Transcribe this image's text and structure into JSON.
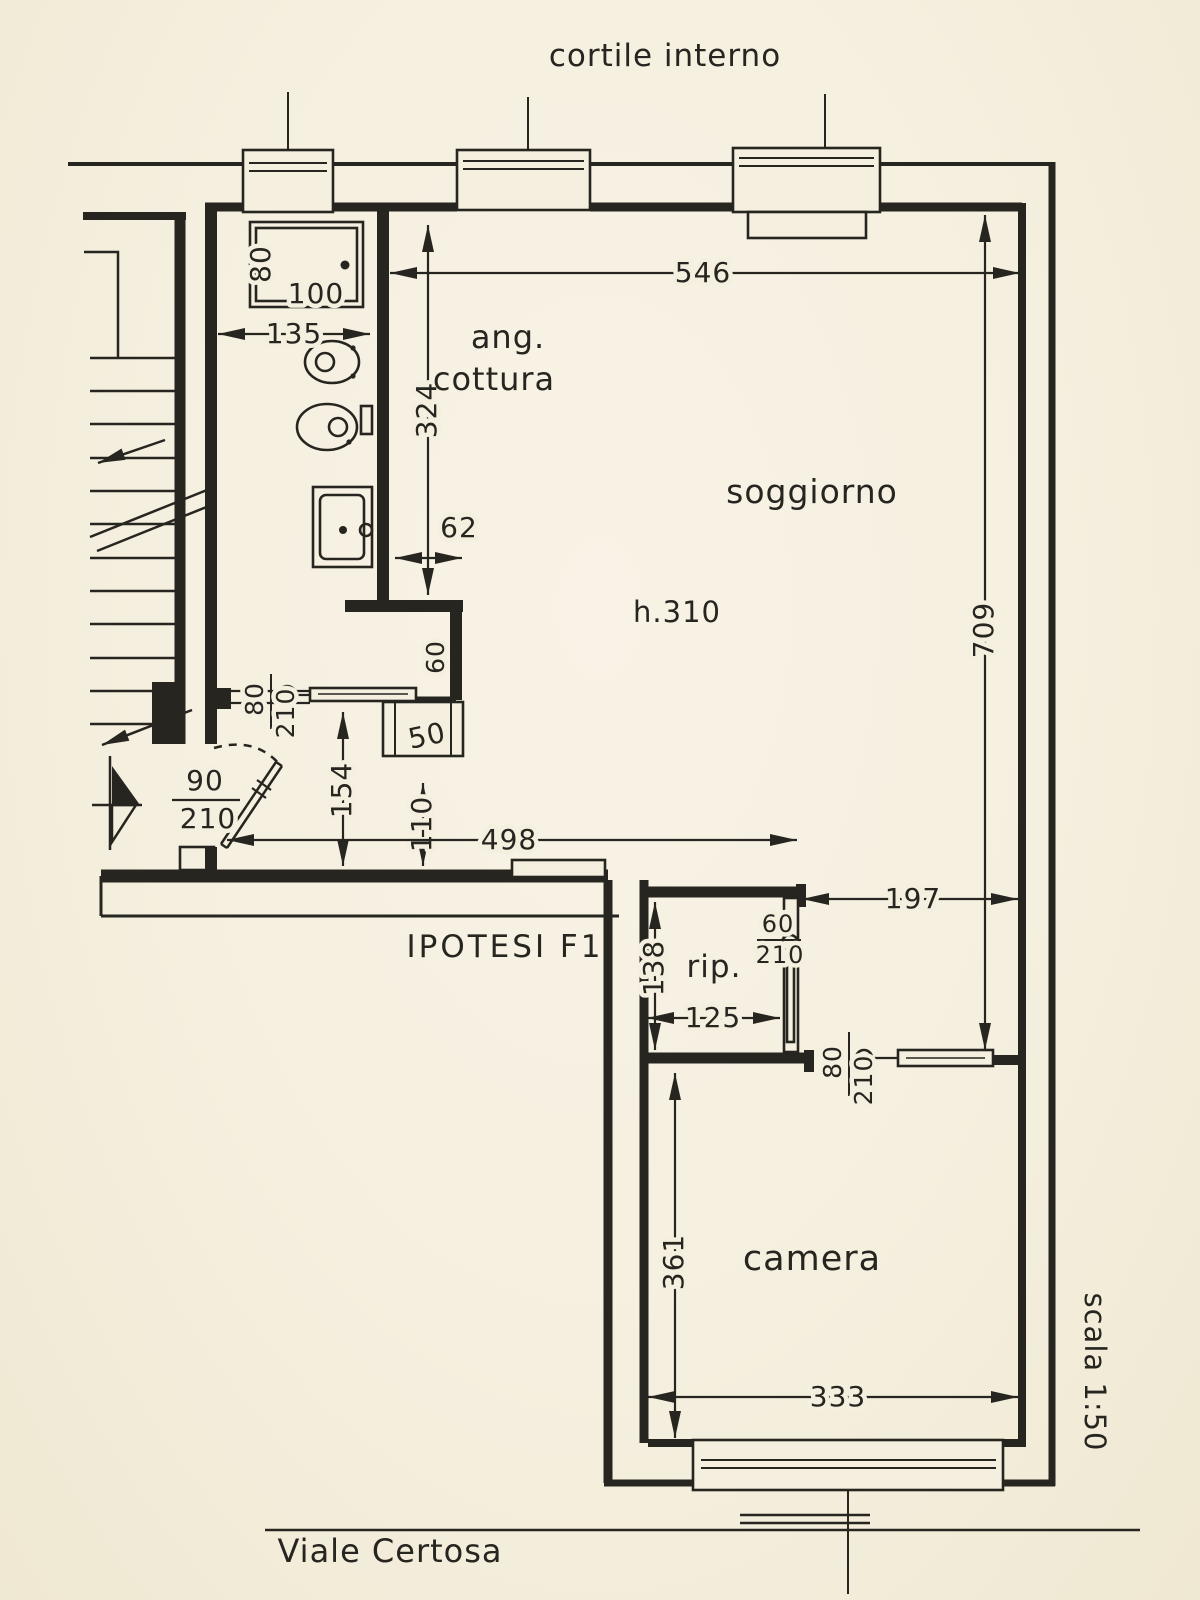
{
  "labels": {
    "courtyard": "cortile interno",
    "street": "Viale Certosa",
    "scale": "scala 1:50",
    "hypothesis": "IPOTESI F1",
    "kitchen_line1": "ang.",
    "kitchen_line2": "cottura",
    "living": "soggiorno",
    "ceiling_height": "h.310",
    "storage": "rip.",
    "bedroom": "camera"
  },
  "dims": {
    "living_width": "546",
    "kitchen_depth": "324",
    "bath_width": "135",
    "shower_width": "80",
    "shower_length": "100",
    "niche_gap": "62",
    "niche_depth": "60",
    "flue_width": "50",
    "hall_depth": "154",
    "hall_inner": "110",
    "hall_width": "498",
    "passage_width": "197",
    "storage_depth": "138",
    "storage_width": "125",
    "living_depth": "709",
    "bedroom_depth": "361",
    "bedroom_width": "333"
  },
  "doors": {
    "bath": {
      "w": "80",
      "h": "210"
    },
    "entry": {
      "w": "90",
      "h": "210"
    },
    "storage": {
      "w": "60",
      "h": "210"
    },
    "bedroom": {
      "w": "80",
      "h": "210"
    }
  },
  "colors": {
    "paper": "#f5efdf",
    "ink": "#26251f"
  }
}
